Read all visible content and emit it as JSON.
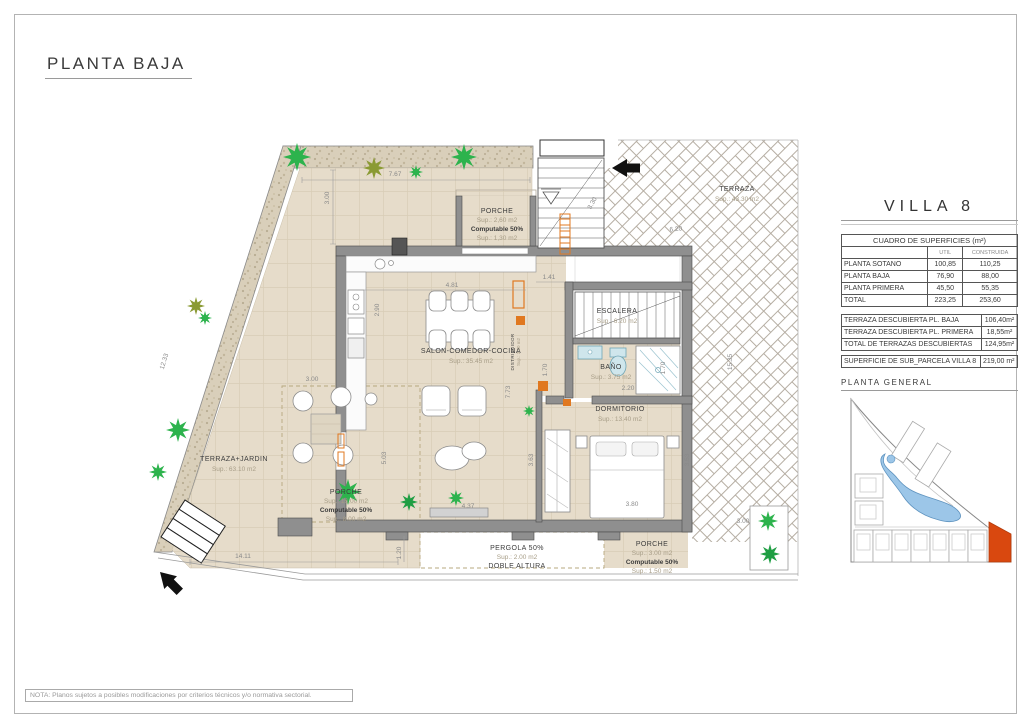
{
  "page": {
    "title": "PLANTA BAJA",
    "note": "NOTA: Planos sujetos a posibles modificaciones por criterios técnicos y/o normativa sectorial."
  },
  "panel": {
    "villa_title": "VILLA 8",
    "surfaces": {
      "title": "CUADRO DE SUPERFICIES (m²)",
      "col_util": "UTIL",
      "col_construida": "CONSTRUIDA",
      "rows": [
        {
          "label": "PLANTA SOTANO",
          "util": "100,85",
          "construida": "110,25"
        },
        {
          "label": "PLANTA BAJA",
          "util": "76,90",
          "construida": "88,00"
        },
        {
          "label": "PLANTA PRIMERA",
          "util": "45,50",
          "construida": "55,35"
        },
        {
          "label": "TOTAL",
          "util": "223,25",
          "construida": "253,60"
        }
      ]
    },
    "terraces": {
      "rows": [
        {
          "label": "TERRAZA DESCUBIERTA PL. BAJA",
          "value": "106,40m²"
        },
        {
          "label": "TERRAZA DESCUBIERTA PL. PRIMERA",
          "value": "18,55m²"
        },
        {
          "label": "TOTAL DE TERRAZAS DESCUBIERTAS",
          "value": "124,95m²"
        }
      ]
    },
    "parcel": {
      "label": "SUPERFICIE DE SUB_PARCELA VILLA 8",
      "value": "219,00 m²"
    },
    "planta_general": "PLANTA GENERAL"
  },
  "plan": {
    "rooms": {
      "porche_top": {
        "name": "PORCHE",
        "sup": "Sup.: 2,60 m2",
        "comp": "Computable 50%",
        "sup2": "Sup.: 1,30 m2"
      },
      "salon": {
        "name": "SALON-COMEDOR-COCINA",
        "sup": "Sup.: 35.45 m2"
      },
      "distribuidor": {
        "name": "DISTRIBUIDOR",
        "sup": "Sup.: 3.30 m2"
      },
      "escalera": {
        "name": "ESCALERA",
        "sup": "Sup.: 6.20 m2"
      },
      "bano": {
        "name": "BAÑO",
        "sup": "Sup.: 3.75 m2"
      },
      "dormitorio": {
        "name": "DORMITORIO",
        "sup": "Sup.: 13.40 m2"
      },
      "terraza_jardin": {
        "name": "TERRAZA+JARDIN",
        "sup": "Sup.: 63.10 m2"
      },
      "porche_left": {
        "name": "PORCHE",
        "sup": "Sup.: 16.00 m2",
        "comp": "Computable 50%",
        "sup2": "Sup.: 8.00 m2"
      },
      "pergola": {
        "name": "PERGOLA 50%",
        "sup": "Sup.: 2.00 m2",
        "l2": "DOBLE ALTURA"
      },
      "porche_bottom": {
        "name": "PORCHE",
        "sup": "Sup.: 3.00 m2",
        "comp": "Computable 50%",
        "sup2": "Sup.: 1.50 m2"
      },
      "terraza": {
        "name": "TERRAZA",
        "sup": "Sup.: 43.30 m2"
      }
    },
    "dims": {
      "top_width": "7.67",
      "top_offset": "3.00",
      "left_height": "12.33",
      "bottom_width": "14.11",
      "bottom_offset": "1.20",
      "kitchen_width": "4.81",
      "kitchen_depth": "2.90",
      "hall_width": "1.41",
      "terrace_top": "6.20",
      "stair_diag": "3.30",
      "salon_height": "7.73",
      "salon_left": "5.03",
      "wardrobe_height": "3.63",
      "dorm_right": "3.53",
      "bed_width": "3.80",
      "salon_bottom": "4.37",
      "bath_width": "2.20",
      "bath_left": "1.70",
      "bath_right": "1.70",
      "right_height": "15.35",
      "planter_width": "3.00",
      "terrace_left_width": "3.00"
    }
  },
  "colors": {
    "villa_highlight": "#d9480f",
    "pool": "#9cc6e8",
    "floor_beige": "#e6dcca",
    "wall_grey": "#8f8f8f",
    "accent_orange": "#e07820",
    "plant_green": "#2db34d",
    "plant_olive": "#8a9a33",
    "fixture_blue": "#cfe6ec"
  }
}
